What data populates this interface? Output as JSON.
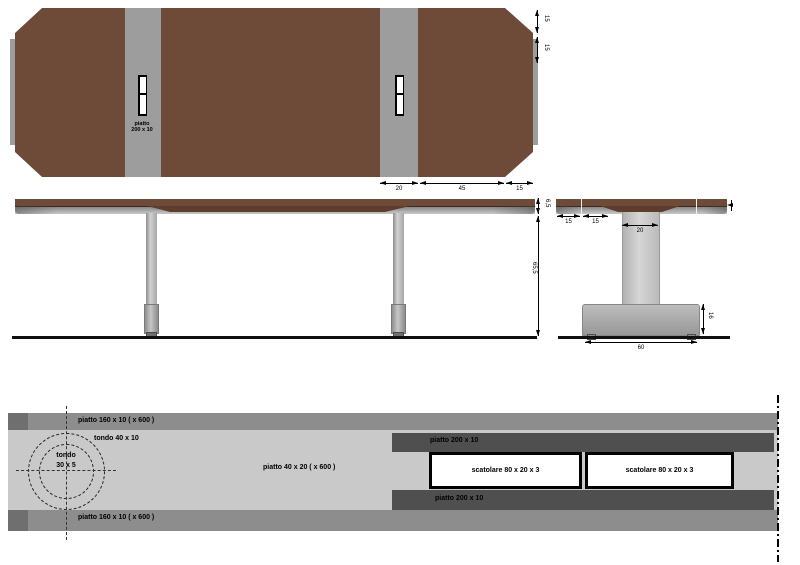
{
  "drawing": {
    "top_view": {
      "plate_label_line1": "piatto",
      "plate_label_line2": "200 x 10",
      "dim_chamfer_right_1": "15",
      "dim_chamfer_right_2": "15",
      "dim_bottom_stripe": "20",
      "dim_bottom_span": "45",
      "dim_bottom_chamfer": "15"
    },
    "side_view": {
      "dim_top_thickness": "6,5",
      "dim_height": "65,5"
    },
    "end_view": {
      "dim_edge_1": "15",
      "dim_edge_2": "15",
      "dim_column_width": "20",
      "dim_base_height": "16",
      "dim_base_width": "60"
    },
    "profile_section": {
      "band_top_label": "piatto 160 x 10 ( x 600 )",
      "band_bottom_label": "piatto 160 x 10 ( x 600 )",
      "ring_outer_label": "tondo 40 x 10",
      "ring_inner_label_line1": "tondo",
      "ring_inner_label_line2": "30 x 5",
      "bar_label": "piatto 40 x 20 ( x 600 )",
      "plate_top_label": "piatto 200 x 10",
      "plate_bottom_label": "piatto 200 x 10",
      "tube_left_label": "scatolare 80 x 20 x 3",
      "tube_right_label": "scatolare 80 x 20 x 3"
    },
    "colors": {
      "tabletop_brown": "#6e4a38",
      "apron_brown": "#5c3d2e",
      "steel_gray": "#9d9d9d",
      "band_medium_gray": "#8d8d8d",
      "band_cap_gray": "#6f6f6f",
      "band_light_gray": "#c9c9c9",
      "plate_dark_gray": "#4f4f4f",
      "line_black": "#000000"
    }
  }
}
